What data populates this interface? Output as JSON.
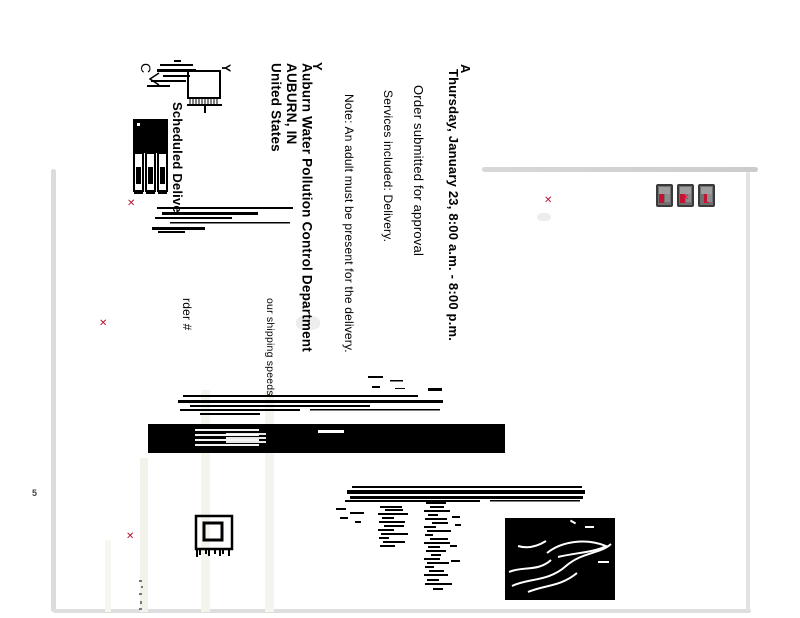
{
  "marks": {
    "a": "A",
    "y_right": "Y",
    "y_box": "Y",
    "c": "C",
    "five": "5"
  },
  "icons": {
    "broken_image_glyph": "✕"
  },
  "delivery": {
    "date_window": "Thursday, January 23, 8:00 a.m. - 8:00 p.m.",
    "status": "Order submitted for approval",
    "services": "Services included: Delivery.",
    "note": "Note: An adult must be present for the delivery."
  },
  "recipient": {
    "name": "Auburn Water Pollution Control Department",
    "city_state": "AUBURN, IN",
    "country": "United States"
  },
  "shipment": {
    "scheduled_label": "Scheduled Delive",
    "order_label": "rder #",
    "shipping_speed_label": "our shipping speeds"
  },
  "colors": {
    "accent_red": "#c01334",
    "ink": "#000000",
    "frame_gray": "#d9d9d9",
    "stripe_tint": "#f4f3ec"
  }
}
